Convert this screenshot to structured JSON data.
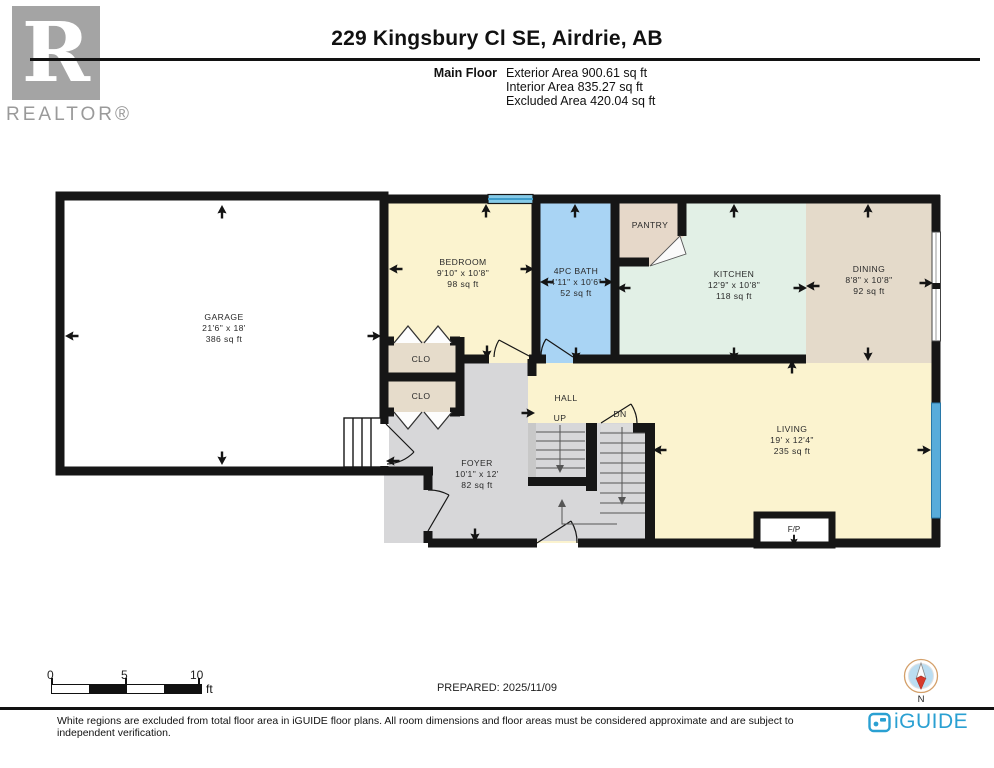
{
  "header": {
    "title": "229 Kingsbury Cl SE, Airdrie, AB",
    "floor_label": "Main Floor",
    "stats": [
      "Exterior Area 900.61 sq ft",
      "Interior Area 835.27 sq ft",
      "Excluded Area 420.04 sq ft"
    ],
    "realtor": {
      "letter": "R",
      "label": "REALTOR®"
    }
  },
  "rooms": {
    "garage": {
      "name": "GARAGE",
      "dims": "21'6\" x 18'",
      "area": "386 sq ft"
    },
    "bedroom": {
      "name": "BEDROOM",
      "dims": "9'10\" x 10'8\"",
      "area": "98 sq ft"
    },
    "bath": {
      "name": "4PC BATH",
      "dims": "4'11\" x 10'6\"",
      "area": "52 sq ft"
    },
    "pantry": {
      "name": "PANTRY"
    },
    "kitchen": {
      "name": "KITCHEN",
      "dims": "12'9\" x 10'8\"",
      "area": "118 sq ft"
    },
    "dining": {
      "name": "DINING",
      "dims": "8'8\" x 10'8\"",
      "area": "92 sq ft"
    },
    "living": {
      "name": "LIVING",
      "dims": "19' x 12'4\"",
      "area": "235 sq ft"
    },
    "hall": {
      "name": "HALL"
    },
    "foyer": {
      "name": "FOYER",
      "dims": "10'1\" x 12'",
      "area": "82 sq ft"
    },
    "closet_a": {
      "name": "CLO"
    },
    "closet_b": {
      "name": "CLO"
    },
    "fireplace": {
      "name": "F/P"
    },
    "stairs": {
      "up": "UP",
      "down": "DN"
    }
  },
  "scale_bar": {
    "labels": [
      "0",
      "5",
      "10"
    ],
    "unit": "ft"
  },
  "footer": {
    "prepared": "PREPARED: 2025/11/09",
    "compass_label": "N",
    "brand": "iGUIDE",
    "disclaimer": "White regions are excluded from total floor area in iGUIDE floor plans. All room dimensions and floor areas must be considered approximate and are subject to independent verification."
  },
  "colors": {
    "room_cream": "#FBF3CF",
    "bath_blue": "#A9D4F4",
    "kitchen_mint": "#E2F0E6",
    "tan": "#E5DACA",
    "floor_gray": "#D7D7D9",
    "wall": "#161616",
    "window_blue": "#58ACDA",
    "brand_teal": "#2AA0D2"
  }
}
